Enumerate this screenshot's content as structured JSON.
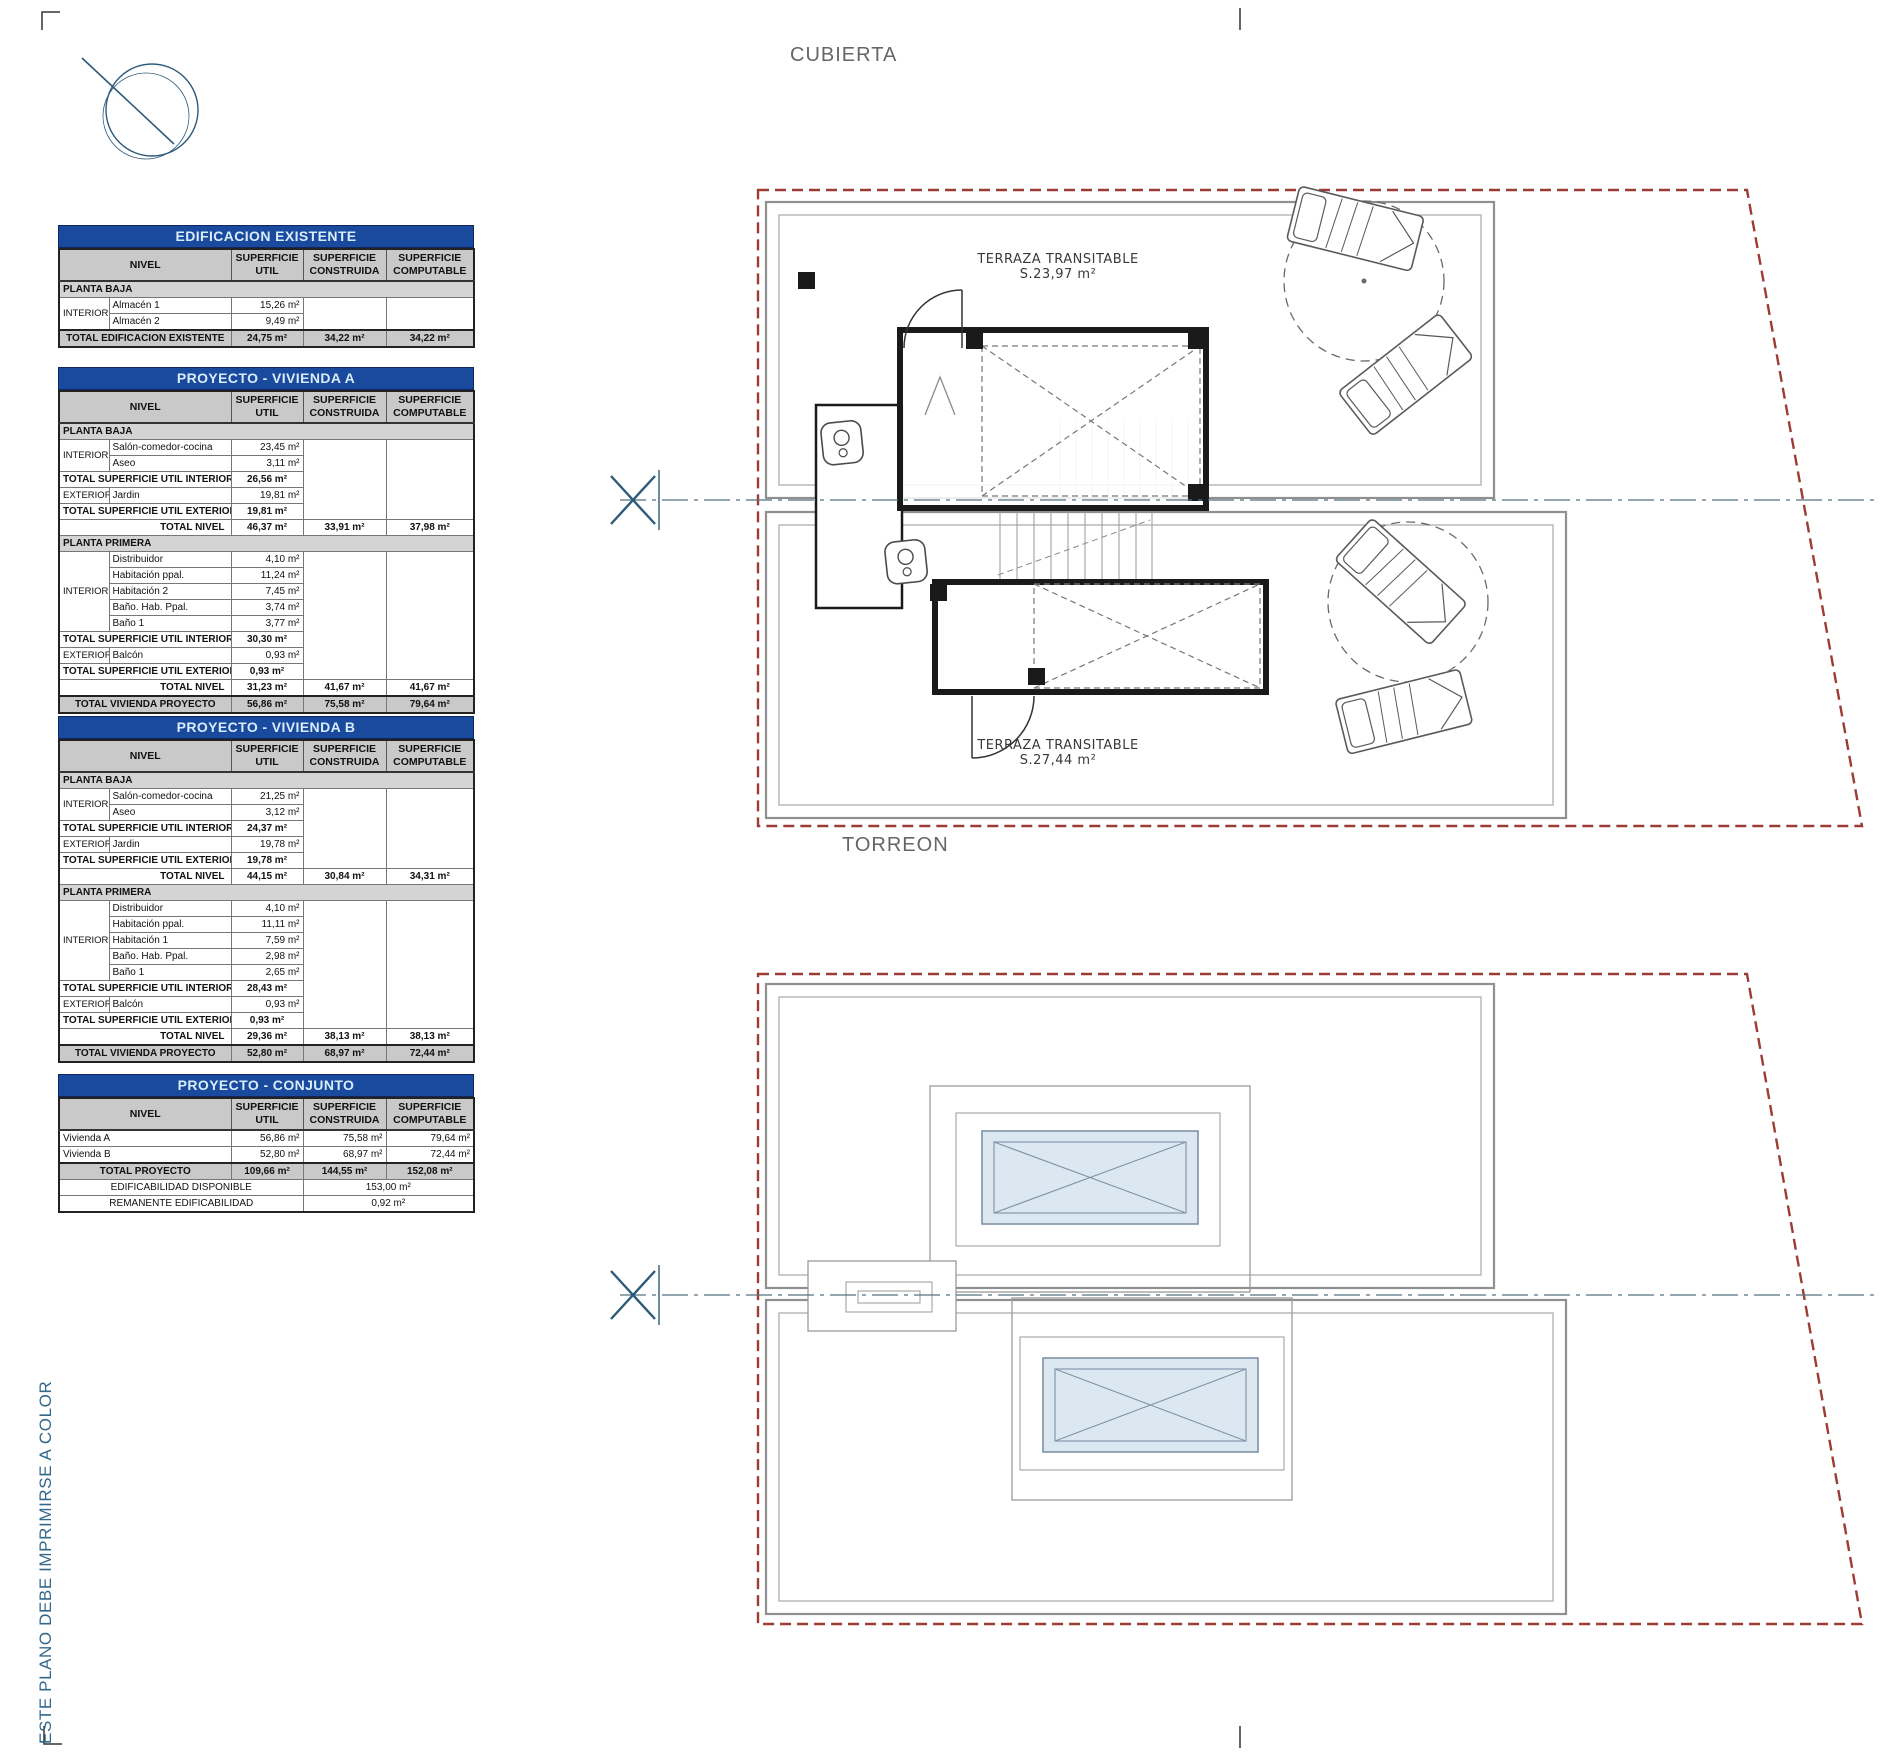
{
  "colors": {
    "title_bar_blue": "#194a9e",
    "title_bar_text": "#d8ecfa",
    "header_gray": "#c9c9c9",
    "section_gray": "#d4d4d4",
    "boundary_red": "#9c3c34",
    "plan_gray": "#8f8f8f",
    "wall_black": "#1a1a1a",
    "glass_blue": "#dbe7f1",
    "accent_blue": "#2e5a7a",
    "note_blue": "#33688a"
  },
  "annotations": {
    "cubierta": "CUBIERTA",
    "torreon": "TORREON",
    "terraza_a_line1": "TERRAZA TRANSITABLE",
    "terraza_a_line2": "S.23,97 m²",
    "terraza_b_line1": "TERRAZA TRANSITABLE",
    "terraza_b_line2": "S.27,44 m²",
    "print_note": "ESTE PLANO DEBE IMPRIMIRSE A COLOR"
  },
  "tables": [
    {
      "id": "edificacion-existente",
      "title": "EDIFICACION EXISTENTE",
      "headers": {
        "nivel": "NIVEL",
        "util": "SUPERFICIE\nUTIL",
        "construida": "SUPERFICIE\nCONSTRUIDA",
        "computable": "SUPERFICIE\nCOMPUTABLE"
      },
      "rows": [
        {
          "cells": [
            {
              "t": "PLANTA BAJA",
              "cls": "section",
              "cs": 5
            }
          ]
        },
        {
          "cells": [
            {
              "t": "INTERIOR",
              "cls": "group",
              "rs": 2
            },
            {
              "t": "Almacén 1",
              "cls": "name"
            },
            {
              "t": "15,26 m²",
              "cls": "num"
            },
            {
              "t": "",
              "cls": "blank",
              "rs": 2
            },
            {
              "t": "",
              "cls": "blank",
              "rs": 2
            }
          ]
        },
        {
          "cells": [
            {
              "t": "Almacén 2",
              "cls": "name"
            },
            {
              "t": "9,49 m²",
              "cls": "num"
            }
          ]
        },
        {
          "cells": [
            {
              "t": "TOTAL EDIFICACION EXISTENTE",
              "cls": "gtotal-label",
              "cs": 2
            },
            {
              "t": "24,75 m²",
              "cls": "gtotal-num"
            },
            {
              "t": "34,22 m²",
              "cls": "gtotal-num"
            },
            {
              "t": "34,22 m²",
              "cls": "gtotal-num"
            }
          ]
        }
      ]
    },
    {
      "id": "proyecto-vivienda-a",
      "title": "PROYECTO - VIVIENDA A",
      "headers": {
        "nivel": "NIVEL",
        "util": "SUPERFICIE\nUTIL",
        "construida": "SUPERFICIE\nCONSTRUIDA",
        "computable": "SUPERFICIE\nCOMPUTABLE"
      },
      "rows": [
        {
          "cells": [
            {
              "t": "PLANTA BAJA",
              "cls": "section",
              "cs": 5
            }
          ]
        },
        {
          "cells": [
            {
              "t": "INTERIOR",
              "cls": "group",
              "rs": 2
            },
            {
              "t": "Salón-comedor-cocina",
              "cls": "name"
            },
            {
              "t": "23,45 m²",
              "cls": "num"
            },
            {
              "t": "",
              "cls": "blank",
              "rs": 5
            },
            {
              "t": "",
              "cls": "blank",
              "rs": 5
            }
          ]
        },
        {
          "cells": [
            {
              "t": "Aseo",
              "cls": "name"
            },
            {
              "t": "3,11 m²",
              "cls": "num"
            }
          ]
        },
        {
          "cells": [
            {
              "t": "TOTAL SUPERFICIE UTIL INTERIOR",
              "cls": "total-label",
              "cs": 2
            },
            {
              "t": "26,56 m²",
              "cls": "total-num"
            }
          ]
        },
        {
          "cells": [
            {
              "t": "EXTERIOR",
              "cls": "group"
            },
            {
              "t": "Jardin",
              "cls": "name"
            },
            {
              "t": "19,81 m²",
              "cls": "num"
            }
          ]
        },
        {
          "cells": [
            {
              "t": "TOTAL SUPERFICIE UTIL EXTERIOR",
              "cls": "total-label",
              "cs": 2
            },
            {
              "t": "19,81 m²",
              "cls": "total-num"
            }
          ]
        },
        {
          "cells": [
            {
              "t": "TOTAL NIVEL",
              "cls": "nivel-label",
              "cs": 2
            },
            {
              "t": "46,37 m²",
              "cls": "total-num"
            },
            {
              "t": "33,91 m²",
              "cls": "total-num"
            },
            {
              "t": "37,98 m²",
              "cls": "total-num"
            }
          ]
        },
        {
          "cells": [
            {
              "t": "PLANTA PRIMERA",
              "cls": "section",
              "cs": 5
            }
          ]
        },
        {
          "cells": [
            {
              "t": "INTERIOR",
              "cls": "group",
              "rs": 5
            },
            {
              "t": "Distribuidor",
              "cls": "name"
            },
            {
              "t": "4,10 m²",
              "cls": "num"
            },
            {
              "t": "",
              "cls": "blank",
              "rs": 8
            },
            {
              "t": "",
              "cls": "blank",
              "rs": 8
            }
          ]
        },
        {
          "cells": [
            {
              "t": "Habitación ppal.",
              "cls": "name"
            },
            {
              "t": "11,24 m²",
              "cls": "num"
            }
          ]
        },
        {
          "cells": [
            {
              "t": "Habitación 2",
              "cls": "name"
            },
            {
              "t": "7,45 m²",
              "cls": "num"
            }
          ]
        },
        {
          "cells": [
            {
              "t": "Baño. Hab. Ppal.",
              "cls": "name"
            },
            {
              "t": "3,74 m²",
              "cls": "num"
            }
          ]
        },
        {
          "cells": [
            {
              "t": "Baño 1",
              "cls": "name"
            },
            {
              "t": "3,77 m²",
              "cls": "num"
            }
          ]
        },
        {
          "cells": [
            {
              "t": "TOTAL SUPERFICIE UTIL INTERIOR",
              "cls": "total-label",
              "cs": 2
            },
            {
              "t": "30,30 m²",
              "cls": "total-num"
            }
          ]
        },
        {
          "cells": [
            {
              "t": "EXTERIOR",
              "cls": "group"
            },
            {
              "t": "Balcón",
              "cls": "name"
            },
            {
              "t": "0,93 m²",
              "cls": "num"
            }
          ]
        },
        {
          "cells": [
            {
              "t": "TOTAL SUPERFICIE UTIL EXTERIOR",
              "cls": "total-label",
              "cs": 2
            },
            {
              "t": "0,93 m²",
              "cls": "total-num"
            }
          ]
        },
        {
          "cells": [
            {
              "t": "TOTAL NIVEL",
              "cls": "nivel-label",
              "cs": 2
            },
            {
              "t": "31,23 m²",
              "cls": "total-num"
            },
            {
              "t": "41,67 m²",
              "cls": "total-num"
            },
            {
              "t": "41,67 m²",
              "cls": "total-num"
            }
          ]
        },
        {
          "cells": [
            {
              "t": "TOTAL VIVIENDA PROYECTO",
              "cls": "gtotal-label",
              "cs": 2
            },
            {
              "t": "56,86 m²",
              "cls": "gtotal-num"
            },
            {
              "t": "75,58 m²",
              "cls": "gtotal-num"
            },
            {
              "t": "79,64 m²",
              "cls": "gtotal-num"
            }
          ]
        }
      ]
    },
    {
      "id": "proyecto-vivienda-b",
      "title": "PROYECTO - VIVIENDA B",
      "headers": {
        "nivel": "NIVEL",
        "util": "SUPERFICIE\nUTIL",
        "construida": "SUPERFICIE\nCONSTRUIDA",
        "computable": "SUPERFICIE\nCOMPUTABLE"
      },
      "rows": [
        {
          "cells": [
            {
              "t": "PLANTA BAJA",
              "cls": "section",
              "cs": 5
            }
          ]
        },
        {
          "cells": [
            {
              "t": "INTERIOR",
              "cls": "group",
              "rs": 2
            },
            {
              "t": "Salón-comedor-cocina",
              "cls": "name"
            },
            {
              "t": "21,25 m²",
              "cls": "num"
            },
            {
              "t": "",
              "cls": "blank",
              "rs": 5
            },
            {
              "t": "",
              "cls": "blank",
              "rs": 5
            }
          ]
        },
        {
          "cells": [
            {
              "t": "Aseo",
              "cls": "name"
            },
            {
              "t": "3,12 m²",
              "cls": "num"
            }
          ]
        },
        {
          "cells": [
            {
              "t": "TOTAL SUPERFICIE UTIL INTERIOR",
              "cls": "total-label",
              "cs": 2
            },
            {
              "t": "24,37 m²",
              "cls": "total-num"
            }
          ]
        },
        {
          "cells": [
            {
              "t": "EXTERIOR",
              "cls": "group"
            },
            {
              "t": "Jardin",
              "cls": "name"
            },
            {
              "t": "19,78 m²",
              "cls": "num"
            }
          ]
        },
        {
          "cells": [
            {
              "t": "TOTAL SUPERFICIE UTIL EXTERIOR",
              "cls": "total-label",
              "cs": 2
            },
            {
              "t": "19,78 m²",
              "cls": "total-num"
            }
          ]
        },
        {
          "cells": [
            {
              "t": "TOTAL NIVEL",
              "cls": "nivel-label",
              "cs": 2
            },
            {
              "t": "44,15 m²",
              "cls": "total-num"
            },
            {
              "t": "30,84 m²",
              "cls": "total-num"
            },
            {
              "t": "34,31 m²",
              "cls": "total-num"
            }
          ]
        },
        {
          "cells": [
            {
              "t": "PLANTA PRIMERA",
              "cls": "section",
              "cs": 5
            }
          ]
        },
        {
          "cells": [
            {
              "t": "INTERIOR",
              "cls": "group",
              "rs": 5
            },
            {
              "t": "Distribuidor",
              "cls": "name"
            },
            {
              "t": "4,10 m²",
              "cls": "num"
            },
            {
              "t": "",
              "cls": "blank",
              "rs": 8
            },
            {
              "t": "",
              "cls": "blank",
              "rs": 8
            }
          ]
        },
        {
          "cells": [
            {
              "t": "Habitación ppal.",
              "cls": "name"
            },
            {
              "t": "11,11 m²",
              "cls": "num"
            }
          ]
        },
        {
          "cells": [
            {
              "t": "Habitación 1",
              "cls": "name"
            },
            {
              "t": "7,59 m²",
              "cls": "num"
            }
          ]
        },
        {
          "cells": [
            {
              "t": "Baño. Hab. Ppal.",
              "cls": "name"
            },
            {
              "t": "2,98 m²",
              "cls": "num"
            }
          ]
        },
        {
          "cells": [
            {
              "t": "Baño 1",
              "cls": "name"
            },
            {
              "t": "2,65 m²",
              "cls": "num"
            }
          ]
        },
        {
          "cells": [
            {
              "t": "TOTAL SUPERFICIE UTIL INTERIOR",
              "cls": "total-label",
              "cs": 2
            },
            {
              "t": "28,43 m²",
              "cls": "total-num"
            }
          ]
        },
        {
          "cells": [
            {
              "t": "EXTERIOR",
              "cls": "group"
            },
            {
              "t": "Balcón",
              "cls": "name"
            },
            {
              "t": "0,93 m²",
              "cls": "num"
            }
          ]
        },
        {
          "cells": [
            {
              "t": "TOTAL SUPERFICIE UTIL EXTERIOR",
              "cls": "total-label",
              "cs": 2
            },
            {
              "t": "0,93 m²",
              "cls": "total-num"
            }
          ]
        },
        {
          "cells": [
            {
              "t": "TOTAL NIVEL",
              "cls": "nivel-label",
              "cs": 2
            },
            {
              "t": "29,36 m²",
              "cls": "total-num"
            },
            {
              "t": "38,13 m²",
              "cls": "total-num"
            },
            {
              "t": "38,13 m²",
              "cls": "total-num"
            }
          ]
        },
        {
          "cells": [
            {
              "t": "TOTAL VIVIENDA PROYECTO",
              "cls": "gtotal-label",
              "cs": 2
            },
            {
              "t": "52,80 m²",
              "cls": "gtotal-num"
            },
            {
              "t": "68,97 m²",
              "cls": "gtotal-num"
            },
            {
              "t": "72,44 m²",
              "cls": "gtotal-num"
            }
          ]
        }
      ]
    },
    {
      "id": "proyecto-conjunto",
      "title": "PROYECTO - CONJUNTO",
      "headers": {
        "nivel": "NIVEL",
        "util": "SUPERFICIE\nUTIL",
        "construida": "SUPERFICIE\nCONSTRUIDA",
        "computable": "SUPERFICIE\nCOMPUTABLE"
      },
      "rows": [
        {
          "cells": [
            {
              "t": "Vivienda A",
              "cls": "name-full",
              "cs": 2
            },
            {
              "t": "56,86 m²",
              "cls": "num"
            },
            {
              "t": "75,58 m²",
              "cls": "num"
            },
            {
              "t": "79,64 m²",
              "cls": "num"
            }
          ]
        },
        {
          "cells": [
            {
              "t": "Vivienda B",
              "cls": "name-full",
              "cs": 2
            },
            {
              "t": "52,80 m²",
              "cls": "num"
            },
            {
              "t": "68,97 m²",
              "cls": "num"
            },
            {
              "t": "72,44 m²",
              "cls": "num"
            }
          ]
        },
        {
          "cells": [
            {
              "t": "TOTAL PROYECTO",
              "cls": "gtotal-label",
              "cs": 2
            },
            {
              "t": "109,66 m²",
              "cls": "gtotal-num"
            },
            {
              "t": "144,55 m²",
              "cls": "gtotal-num"
            },
            {
              "t": "152,08 m²",
              "cls": "gtotal-num"
            }
          ]
        },
        {
          "cells": [
            {
              "t": "EDIFICABILIDAD DISPONIBLE",
              "cls": "edif-label",
              "cs": 3
            },
            {
              "t": "153,00 m²",
              "cls": "edif-label",
              "cs": 2
            }
          ]
        },
        {
          "cells": [
            {
              "t": "REMANENTE EDIFICABILIDAD",
              "cls": "edif-label",
              "cs": 3
            },
            {
              "t": "0,92 m²",
              "cls": "edif-label",
              "cs": 2
            }
          ]
        }
      ]
    }
  ]
}
